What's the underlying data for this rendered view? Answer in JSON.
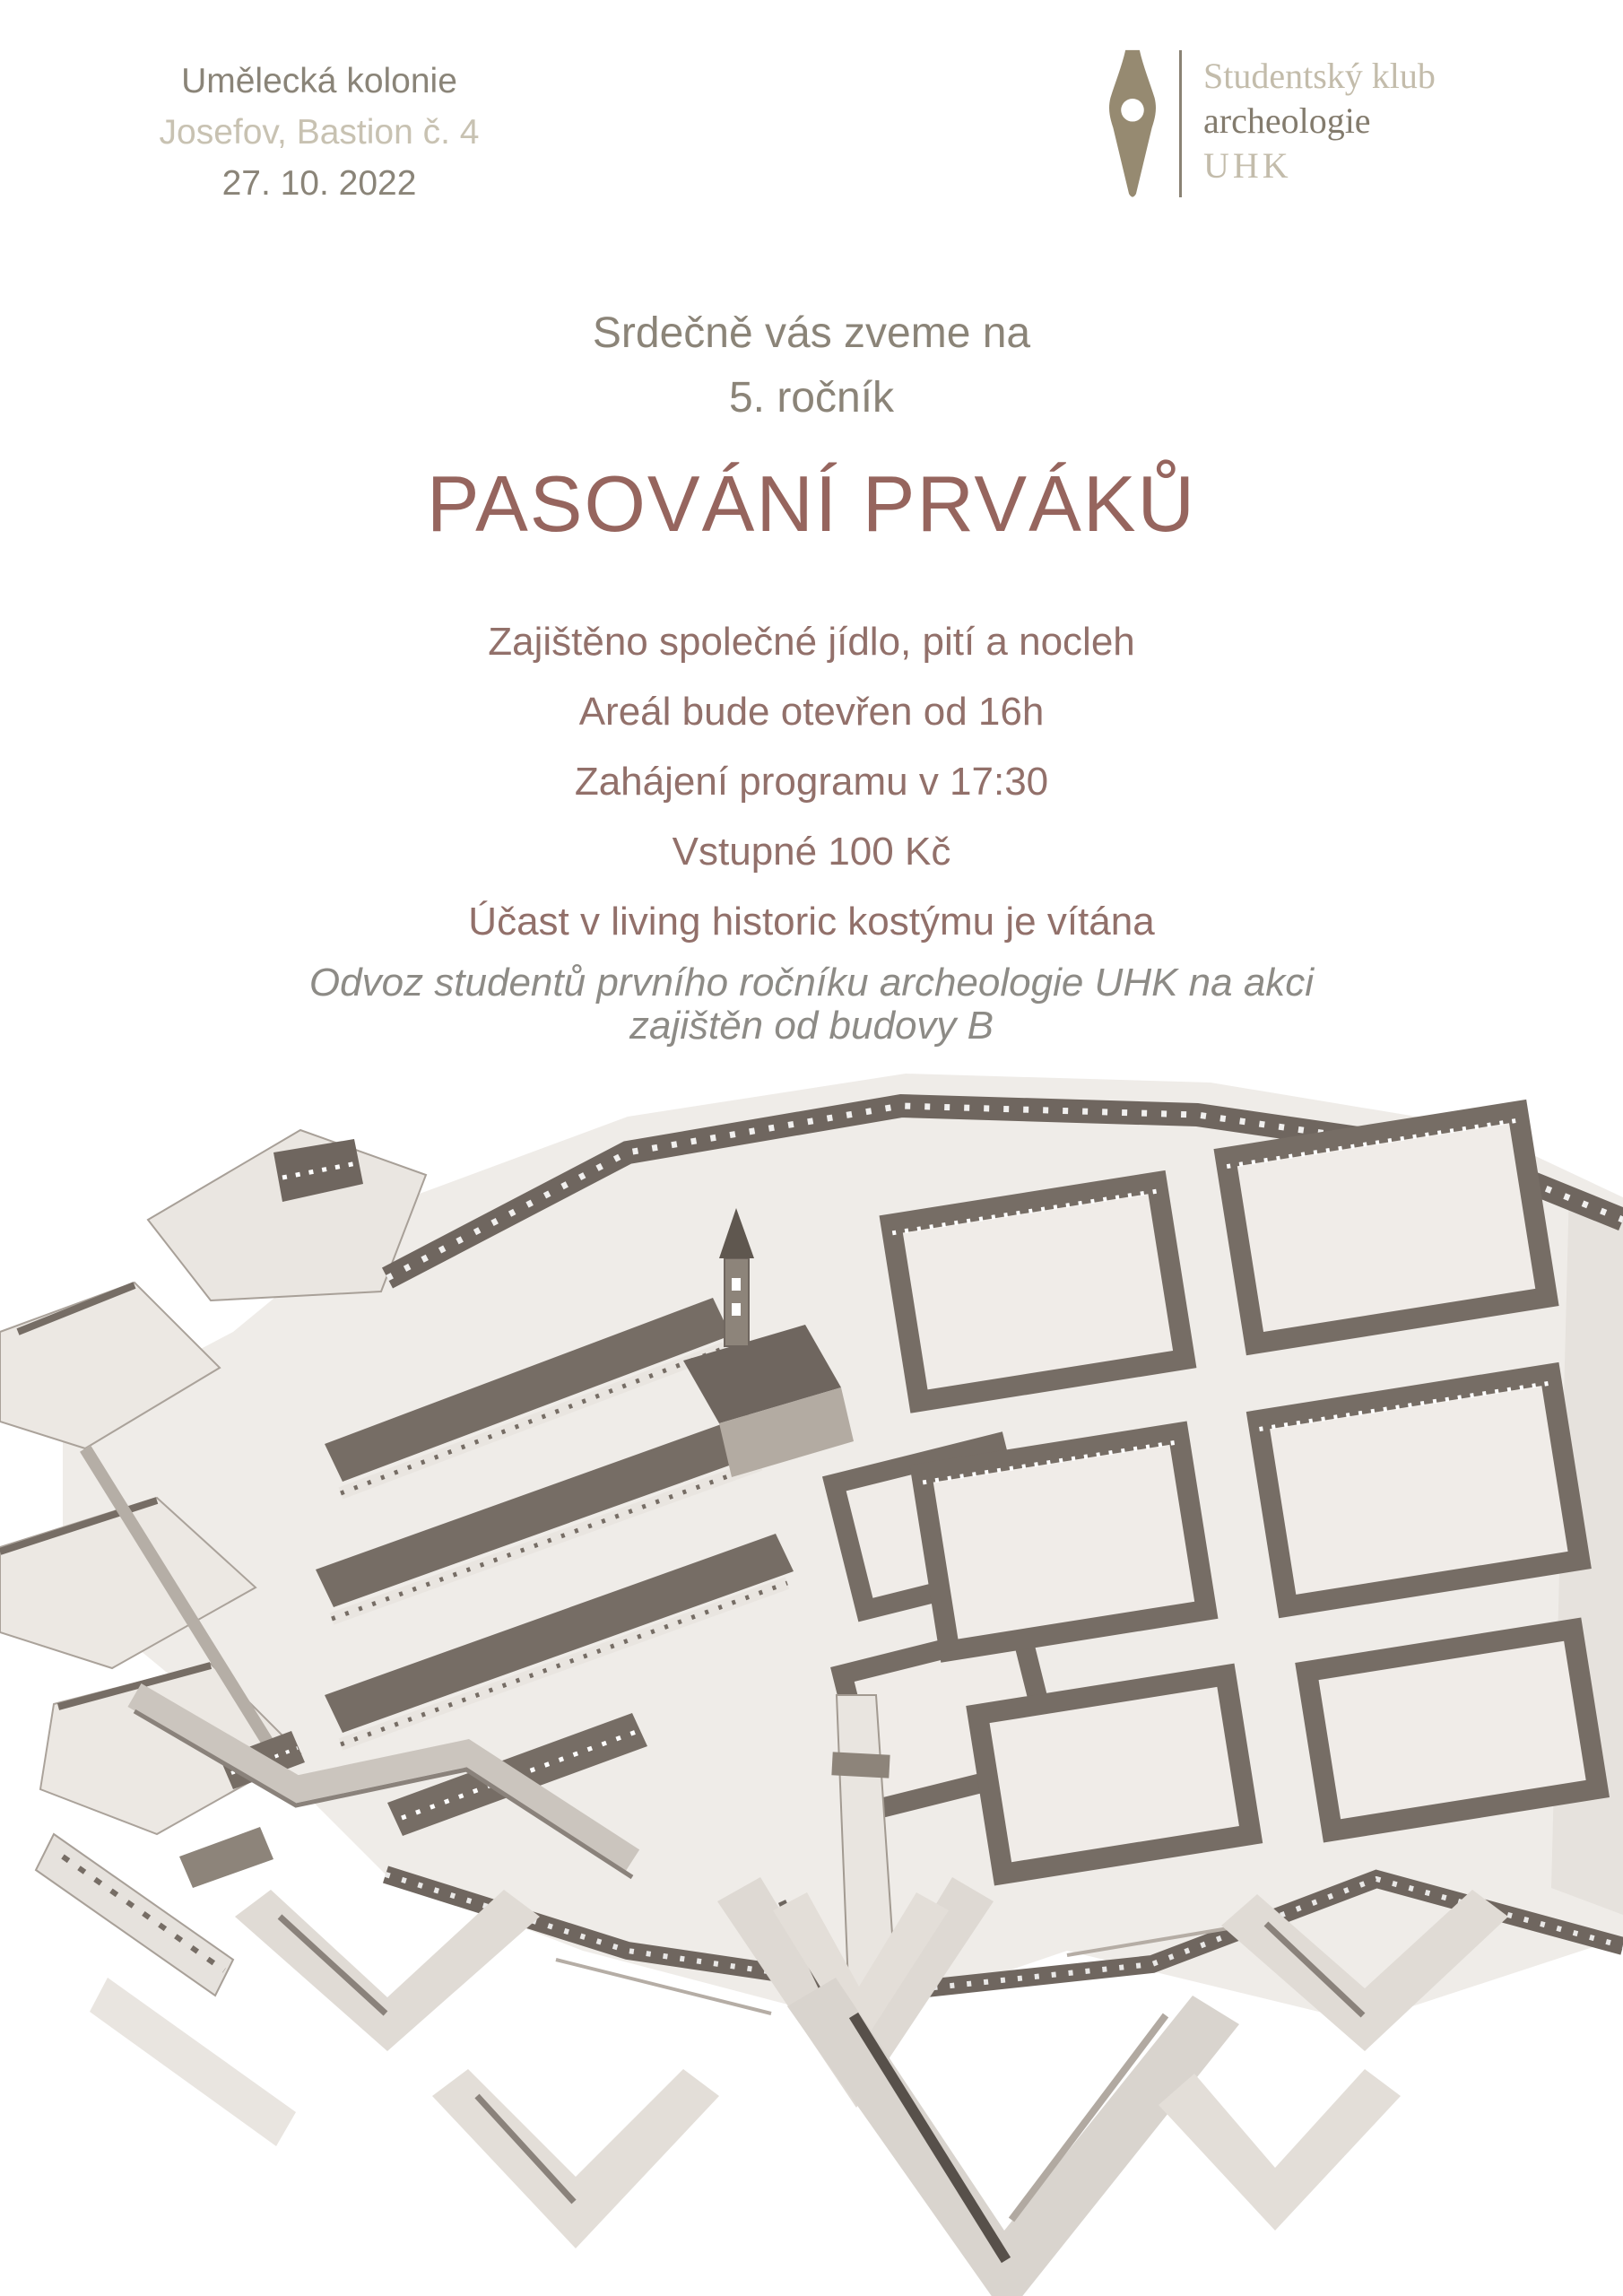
{
  "poster": {
    "header": {
      "venue": "Umělecká kolonie",
      "location": "Josefov, Bastion č. 4",
      "date": "27. 10. 2022"
    },
    "logo": {
      "line1": "Studentský klub",
      "line2": "archeologie",
      "line3": "UHK",
      "icon": "pen-nib-icon"
    },
    "invitation": {
      "line1": "Srdečně vás zveme na",
      "line2": "5. ročník"
    },
    "title": "PASOVÁNÍ PRVÁKŮ",
    "details": [
      "Zajištěno společné jídlo, pití a nocleh",
      "Areál bude otevřen od 16h",
      "Zahájení programu v 17:30",
      "Vstupné 100 Kč",
      "Účast v living historic kostýmu je vítána"
    ],
    "note_line1": "Odvoz studentů prvního ročníku archeologie UHK na akci",
    "note_line2": "zajištěn od budovy B",
    "photo": {
      "alt": "Aerial photograph of a scale model of the Josefov star fortress town"
    },
    "colors": {
      "header_olive": "#8a8478",
      "header_tan": "#c8c2b2",
      "logo_taupe": "#968a71",
      "title_mauve": "#96655e",
      "body_mauve": "#92706a",
      "note_gray": "#8d8b86"
    }
  }
}
